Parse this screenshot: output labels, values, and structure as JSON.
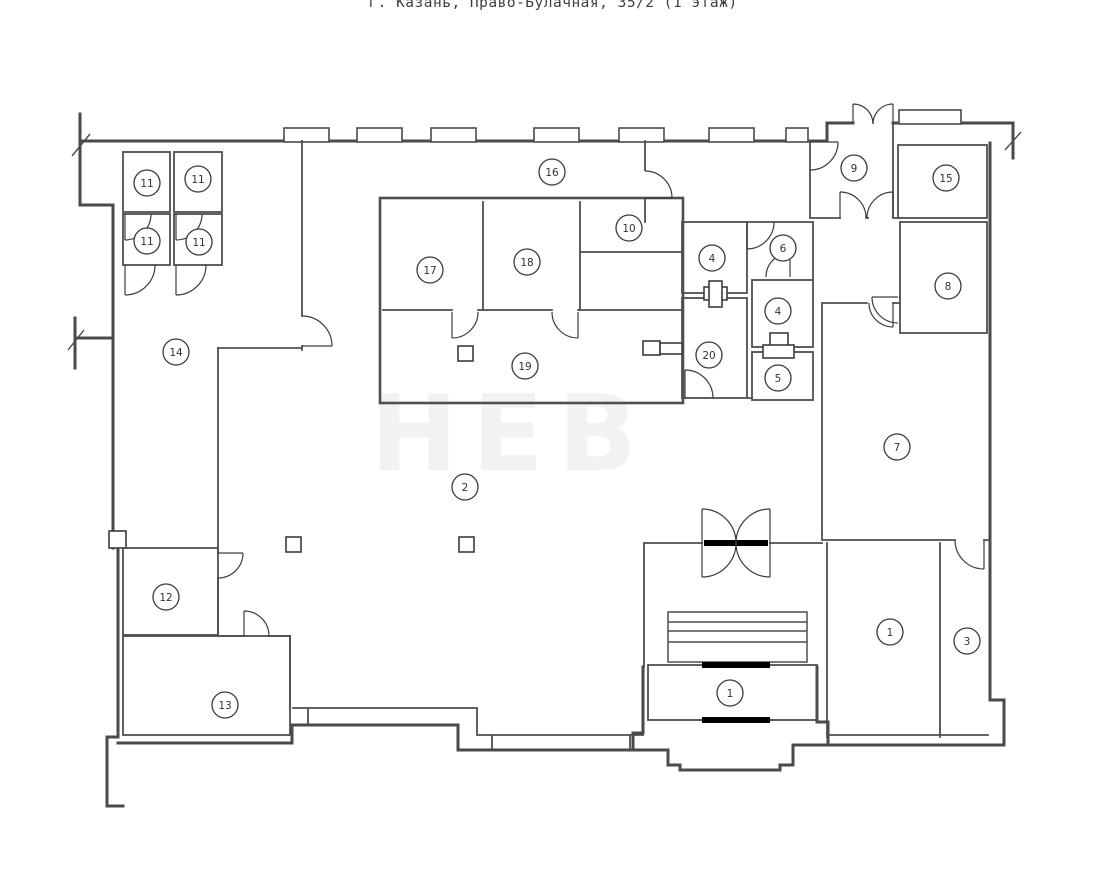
{
  "title": "г. Казань, Право-Булачная, 35/2 (1 этаж)",
  "address": {
    "city": "г. Казань",
    "street": "Право-Булачная",
    "building": "35/2",
    "floor_note": "1 этаж"
  },
  "watermark": {
    "text": "НЕВ"
  },
  "plan": {
    "type": "floor_plan",
    "room_labels": [
      {
        "label": "11",
        "x": 147,
        "y": 183
      },
      {
        "label": "11",
        "x": 198,
        "y": 179
      },
      {
        "label": "11",
        "x": 147,
        "y": 241
      },
      {
        "label": "11",
        "x": 199,
        "y": 242
      },
      {
        "label": "16",
        "x": 552,
        "y": 172
      },
      {
        "label": "17",
        "x": 430,
        "y": 270
      },
      {
        "label": "18",
        "x": 527,
        "y": 262
      },
      {
        "label": "10",
        "x": 629,
        "y": 228
      },
      {
        "label": "19",
        "x": 525,
        "y": 366
      },
      {
        "label": "14",
        "x": 176,
        "y": 352
      },
      {
        "label": "2",
        "x": 465,
        "y": 487
      },
      {
        "label": "12",
        "x": 166,
        "y": 597
      },
      {
        "label": "13",
        "x": 225,
        "y": 705
      },
      {
        "label": "4",
        "x": 712,
        "y": 258
      },
      {
        "label": "6",
        "x": 783,
        "y": 248
      },
      {
        "label": "4",
        "x": 778,
        "y": 311
      },
      {
        "label": "20",
        "x": 709,
        "y": 355
      },
      {
        "label": "5",
        "x": 778,
        "y": 378
      },
      {
        "label": "9",
        "x": 854,
        "y": 168
      },
      {
        "label": "15",
        "x": 946,
        "y": 178
      },
      {
        "label": "8",
        "x": 948,
        "y": 286
      },
      {
        "label": "7",
        "x": 897,
        "y": 447
      },
      {
        "label": "1",
        "x": 890,
        "y": 632
      },
      {
        "label": "3",
        "x": 967,
        "y": 641
      },
      {
        "label": "1",
        "x": 730,
        "y": 693
      }
    ]
  },
  "colors": {
    "wall": "#4a4a4a",
    "background": "#ffffff",
    "label": "#333333",
    "threshold": "#000000"
  }
}
